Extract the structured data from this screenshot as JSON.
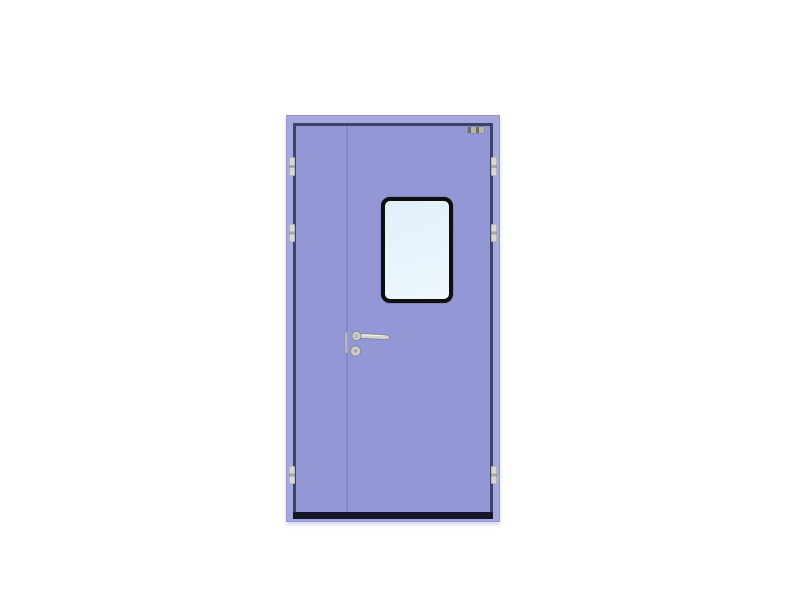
{
  "scene": {
    "description": "Product photo of a lavender purple unequal double-leaf steel cleanroom door on a white background, with a black-framed vision window, stainless lever handle with lock cylinder, flush bolt on the meeting stile, hinges on both outer edges, a dark edge rebate, a black threshold bar and a small grey spec label at the top right"
  },
  "colors": {
    "background": "#ffffff",
    "frame": "#a4a8de",
    "frame_edge": "#9296cc",
    "leaf": "#9397d5",
    "edge_dark": "#3e4266",
    "threshold": "#16182a",
    "stile": "#8488c2",
    "window_frame": "#0f0f10",
    "glass_top": "#e0f0f9",
    "glass_bottom": "#edf8fd",
    "hinge": "#d7d7d7",
    "hinge_notch": "#a8a89e",
    "handle_body": "#d2d2d2",
    "handle_outline": "#868686",
    "lock_dot": "#9a9a9a",
    "bolt_bar": "#b9b9c6",
    "label_plate": "#b5b5ac",
    "label_marks": "#6e6e62"
  },
  "parts": {
    "door": "cleanroom double-leaf door",
    "inactive_leaf": "narrow inactive leaf (left)",
    "active_leaf": "wide active leaf (right)",
    "vision_window": "vision window",
    "lever_handle": "lever handle",
    "lock_cylinder": "lock cylinder",
    "flush_bolt": "flush bolt",
    "hinge": "hinge",
    "threshold": "threshold bar",
    "spec_label": "spec label plate"
  }
}
